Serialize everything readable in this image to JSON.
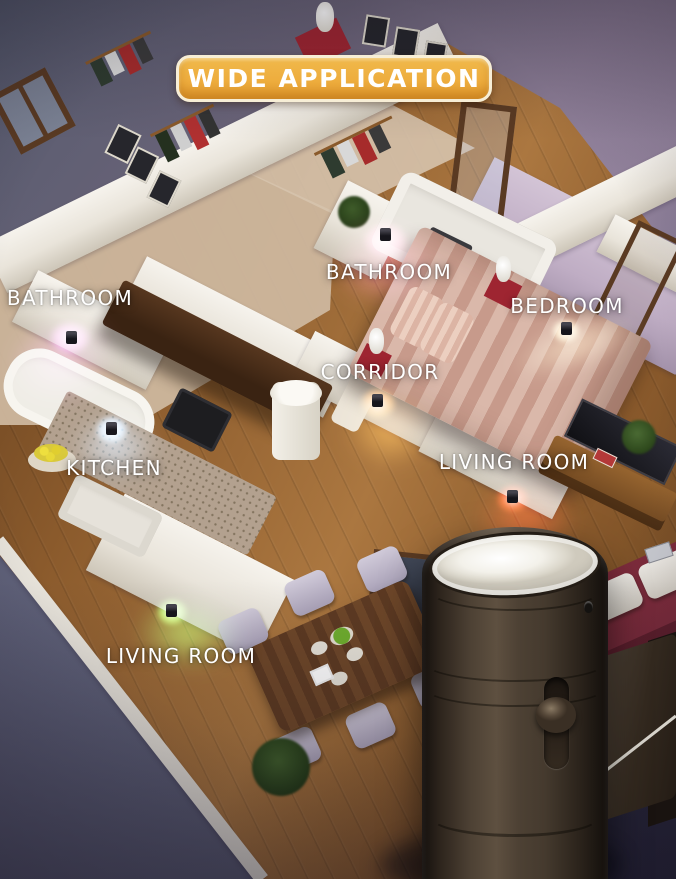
{
  "banner": {
    "label": "WIDE APPLICATION",
    "text_color": "#ffffff",
    "bg_gradient_top": "#f0b94b",
    "bg_gradient_bottom": "#e29a2e",
    "border_color": "#f7eed6"
  },
  "room_labels": [
    {
      "id": "bathroom-left",
      "text": "BATHROOM"
    },
    {
      "id": "bathroom-center",
      "text": "BATHROOM"
    },
    {
      "id": "bedroom",
      "text": "BEDROOM"
    },
    {
      "id": "corridor",
      "text": "CORRIDOR"
    },
    {
      "id": "kitchen",
      "text": "KITCHEN"
    },
    {
      "id": "living-room-right",
      "text": "LIVING ROOM"
    },
    {
      "id": "living-room-bottom",
      "text": "LIVING ROOM"
    }
  ],
  "lights": [
    {
      "room": "BATHROOM (left)",
      "color": "#ef5ed2"
    },
    {
      "room": "BATHROOM (center)",
      "color": "#ff4f8e"
    },
    {
      "room": "BEDROOM",
      "color": "#ffcf96"
    },
    {
      "room": "CORRIDOR",
      "color": "#ff8c2e"
    },
    {
      "room": "KITCHEN",
      "color": "#9fd4ff"
    },
    {
      "room": "LIVING ROOM (right)",
      "color": "#ff2d18"
    },
    {
      "room": "LIVING ROOM (bottom)",
      "color": "#79e14d"
    }
  ],
  "product": {
    "name": "plug-in night light",
    "body_color": "#4d4134",
    "lens_color": "#f3f1ea"
  }
}
